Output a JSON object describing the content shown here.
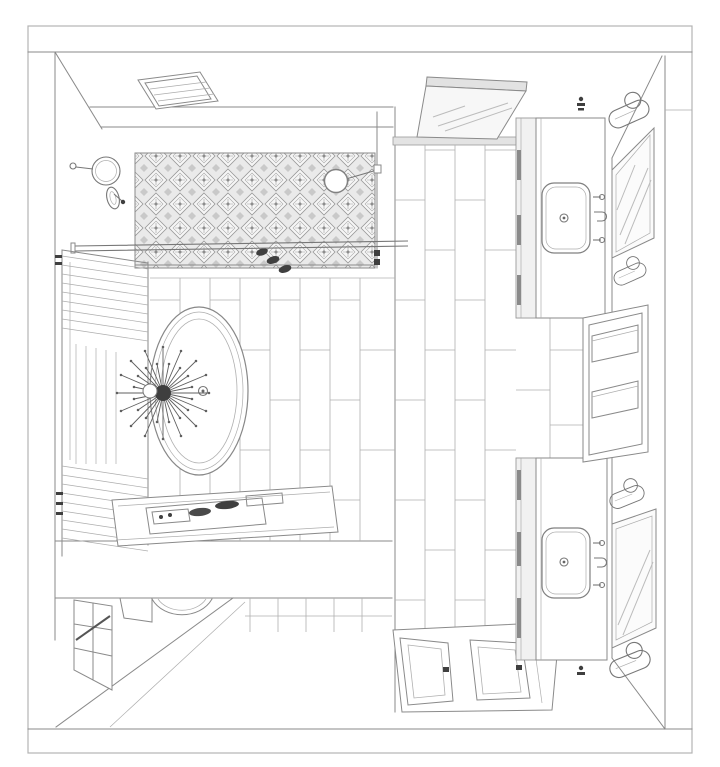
{
  "canvas": {
    "width": 720,
    "height": 767,
    "background": "#ffffff"
  },
  "drawing": {
    "type": "Bathroom floor plan - cutaway axonometric line drawing",
    "colors": {
      "border": "#b3b3b3",
      "line": "#8a8a8a",
      "line_light": "#bcbcbc",
      "line_dark": "#5f5f5f",
      "accent_dark": "#3f3f3f",
      "mosaic_bg": "#eaeaea",
      "glass": "#f7f7f7",
      "band": "#e3e3e3"
    },
    "elements": [
      {
        "name": "skylight",
        "label": "Ceiling skylight with louvers"
      },
      {
        "name": "mosaic-feature-wall",
        "label": "Patterned mosaic shower wall"
      },
      {
        "name": "rain-shower-head",
        "label": "Round rain shower head on wall arm"
      },
      {
        "name": "magnifying-mirror",
        "label": "Wall-mounted magnifying mirror"
      },
      {
        "name": "shower-valve",
        "label": "Shower mixer valve"
      },
      {
        "name": "shower-screen",
        "label": "Glass shower screen rail"
      },
      {
        "name": "shower-door",
        "label": "Hinged glass shower door"
      },
      {
        "name": "toiletry-bottles",
        "label": "Bottles on shower ledge"
      },
      {
        "name": "window-blinds",
        "label": "Window with venetian blinds"
      },
      {
        "name": "bathtub",
        "label": "Freestanding oval bathtub"
      },
      {
        "name": "tub-drain",
        "label": "Bathtub drain"
      },
      {
        "name": "chandelier",
        "label": "Sputnik chandelier over tub"
      },
      {
        "name": "floor-tiles",
        "label": "Large-format staggered floor tiles"
      },
      {
        "name": "bench",
        "label": "Bench with vanity tray and accessories"
      },
      {
        "name": "toilet",
        "label": "Toilet seen in lower cutaway"
      },
      {
        "name": "lower-window",
        "label": "Lower-level window with muntins"
      },
      {
        "name": "entry-doors",
        "label": "Double entry doors shown open"
      },
      {
        "name": "vanity-upper",
        "label": "Upper vanity cabinet with sink"
      },
      {
        "name": "vanity-lower",
        "label": "Lower vanity cabinet with sink"
      },
      {
        "name": "wall-niche",
        "label": "Recessed wall niche with shelves"
      },
      {
        "name": "mirror-upper",
        "label": "Framed wall mirror"
      },
      {
        "name": "mirror-lower",
        "label": "Framed wall mirror"
      },
      {
        "name": "towel-holders",
        "label": "Oval towel holders beside mirrors"
      },
      {
        "name": "wall-hook-upper",
        "label": "Wall hook"
      },
      {
        "name": "wall-hook-lower",
        "label": "Wall hook"
      }
    ]
  }
}
